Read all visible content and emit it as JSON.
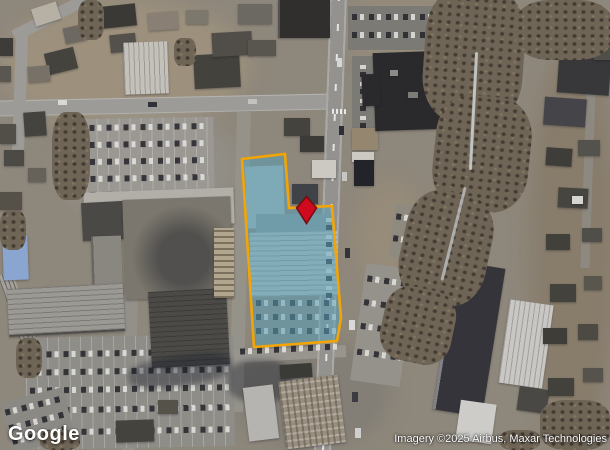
{
  "map": {
    "provider": "Google",
    "attribution": "Imagery ©2025 Airbus, Maxar Technologies",
    "view_type": "satellite"
  },
  "parcel": {
    "points": "242,159 285,154 289,208 332,206 341,318 337,341 254,347",
    "fill_color": "#57A2BA",
    "fill_opacity": "0.52",
    "outline_color": "#F4A504",
    "outline_width": "2.6"
  },
  "marker": {
    "points": "306.5,196.5 316.5,208 306.5,223.5 296.5,208",
    "fill_color": "#CF0A1E",
    "outline_color": "#70100F",
    "outline_width": "1.6"
  }
}
